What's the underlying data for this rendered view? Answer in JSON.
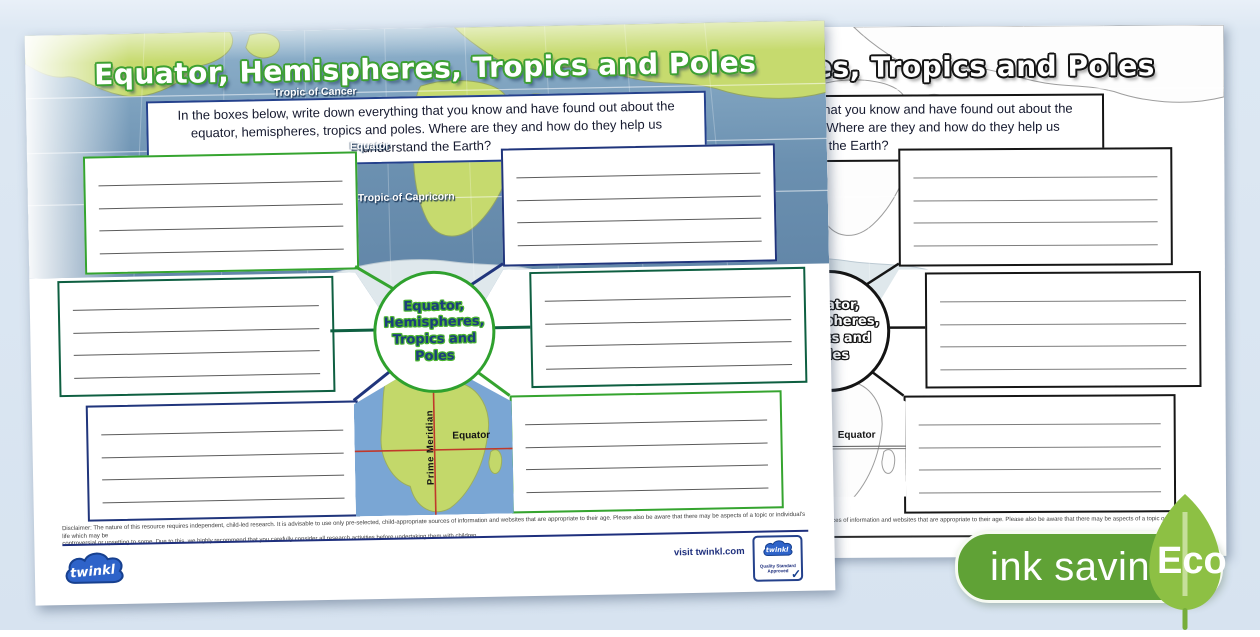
{
  "front_page": {
    "title": "Equator, Hemispheres, Tropics and Poles",
    "instructions": "In the boxes below, write down everything that you know and have found out about the equator, hemispheres, tropics and poles. Where are they and how do they help us understand the Earth?",
    "map_labels": {
      "tropic_of_cancer": "Tropic of Cancer",
      "equator": "Equator",
      "tropic_of_capricorn": "Tropic of Capricorn"
    },
    "bottom_map": {
      "equator": "Equator",
      "prime_meridian": "Prime Meridian"
    },
    "center_circle": {
      "line1": "Equator,",
      "line2": "Hemispheres,",
      "line3": "Tropics and",
      "line4": "Poles"
    },
    "disclaimer_line1": "Disclaimer: The nature of this resource requires independent, child-led research. It is advisable to use only pre-selected, child-appropriate sources of information and websites that are appropriate to their age. Please also be aware that there may be aspects of a topic or individual's life which may be",
    "disclaimer_line2": "controversial or upsetting to some. Due to this, we highly recommend that you carefully consider all research activities before undertaking them with children.",
    "footer": {
      "visit_link": "visit twinkl.com",
      "logo_text": "twinkl",
      "badge_logo_text": "twinkl",
      "badge_line1": "Quality Standard",
      "badge_line2": "Approved",
      "badge_check": "✓"
    }
  },
  "back_page": {
    "title": "Equator, Hemispheres, Tropics and Poles",
    "instructions": "In the boxes below, write down everything that you know and have found out about the equator, hemispheres, tropics and poles. Where are they and how do they help us understand the Earth?",
    "center_circle": {
      "line1": "Equator,",
      "line2": "Hemispheres,",
      "line3": "Tropics and",
      "line4": "Poles"
    },
    "map_label_equator": "Equator",
    "disclaimer": "Disclaimer: The nature of this resource requires independent, child-led research. It is advisable to use only pre-selected, child-appropriate sources of information and websites that are appropriate to their age. Please also be aware that there may be aspects of a topic or individual's life which may be"
  },
  "eco_badge": {
    "label": "ink saving",
    "eco": "Eco"
  },
  "colors": {
    "accent_green": "#35a42f",
    "dark_green": "#0e5f41",
    "navy": "#20357c",
    "pill_green": "#60a236",
    "leaf_green": "#8dc044",
    "ocean_top": "#8fb2cc",
    "ocean_bottom": "#5c80a3",
    "land": "#c6da6e",
    "red_line": "#c0392b",
    "background": "#d7e3f0"
  }
}
